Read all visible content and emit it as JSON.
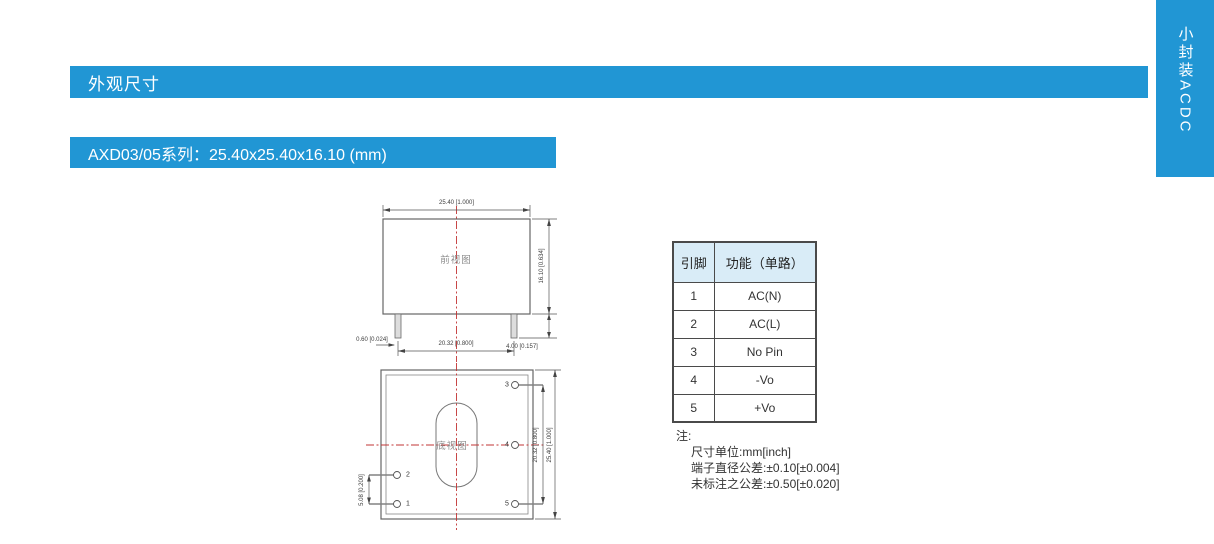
{
  "colors": {
    "accent": "#2196d4",
    "table-header-bg": "#d9ecf7",
    "line": "#5a5a5a",
    "red": "#c23434"
  },
  "header": {
    "section_title": "外观尺寸",
    "series_title": "AXD03/05系列：25.40x25.40x16.10 (mm)"
  },
  "side_tab": {
    "label": "小封装ACDC"
  },
  "front_view": {
    "label": "前视图",
    "dim_top": "25.40 [1.000]",
    "dim_right": "16.10 [0.634]",
    "dim_pin_len": "4.00 [0.157]",
    "dim_pin_span": "20.32 [0.800]",
    "dim_pin_dia": "0.60 [0.024]"
  },
  "bottom_view": {
    "label": "底视图",
    "dim_pin_span": "20.32 [0.800]",
    "dim_body": "25.40 [1.000]",
    "dim_pin_offset": "5.08 [0.200]",
    "pin_numbers": {
      "p1": "1",
      "p2": "2",
      "p3": "3",
      "p4": "4",
      "p5": "5"
    }
  },
  "pin_table": {
    "headers": [
      "引脚",
      "功能（单路）"
    ],
    "rows": [
      {
        "pin": "1",
        "func": "AC(N)"
      },
      {
        "pin": "2",
        "func": "AC(L)"
      },
      {
        "pin": "3",
        "func": "No Pin"
      },
      {
        "pin": "4",
        "func": "-Vo"
      },
      {
        "pin": "5",
        "func": "+Vo"
      }
    ]
  },
  "notes": {
    "title": "注:",
    "lines": [
      "尺寸单位:mm[inch]",
      "端子直径公差:±0.10[±0.004]",
      "未标注之公差:±0.50[±0.020]"
    ]
  }
}
